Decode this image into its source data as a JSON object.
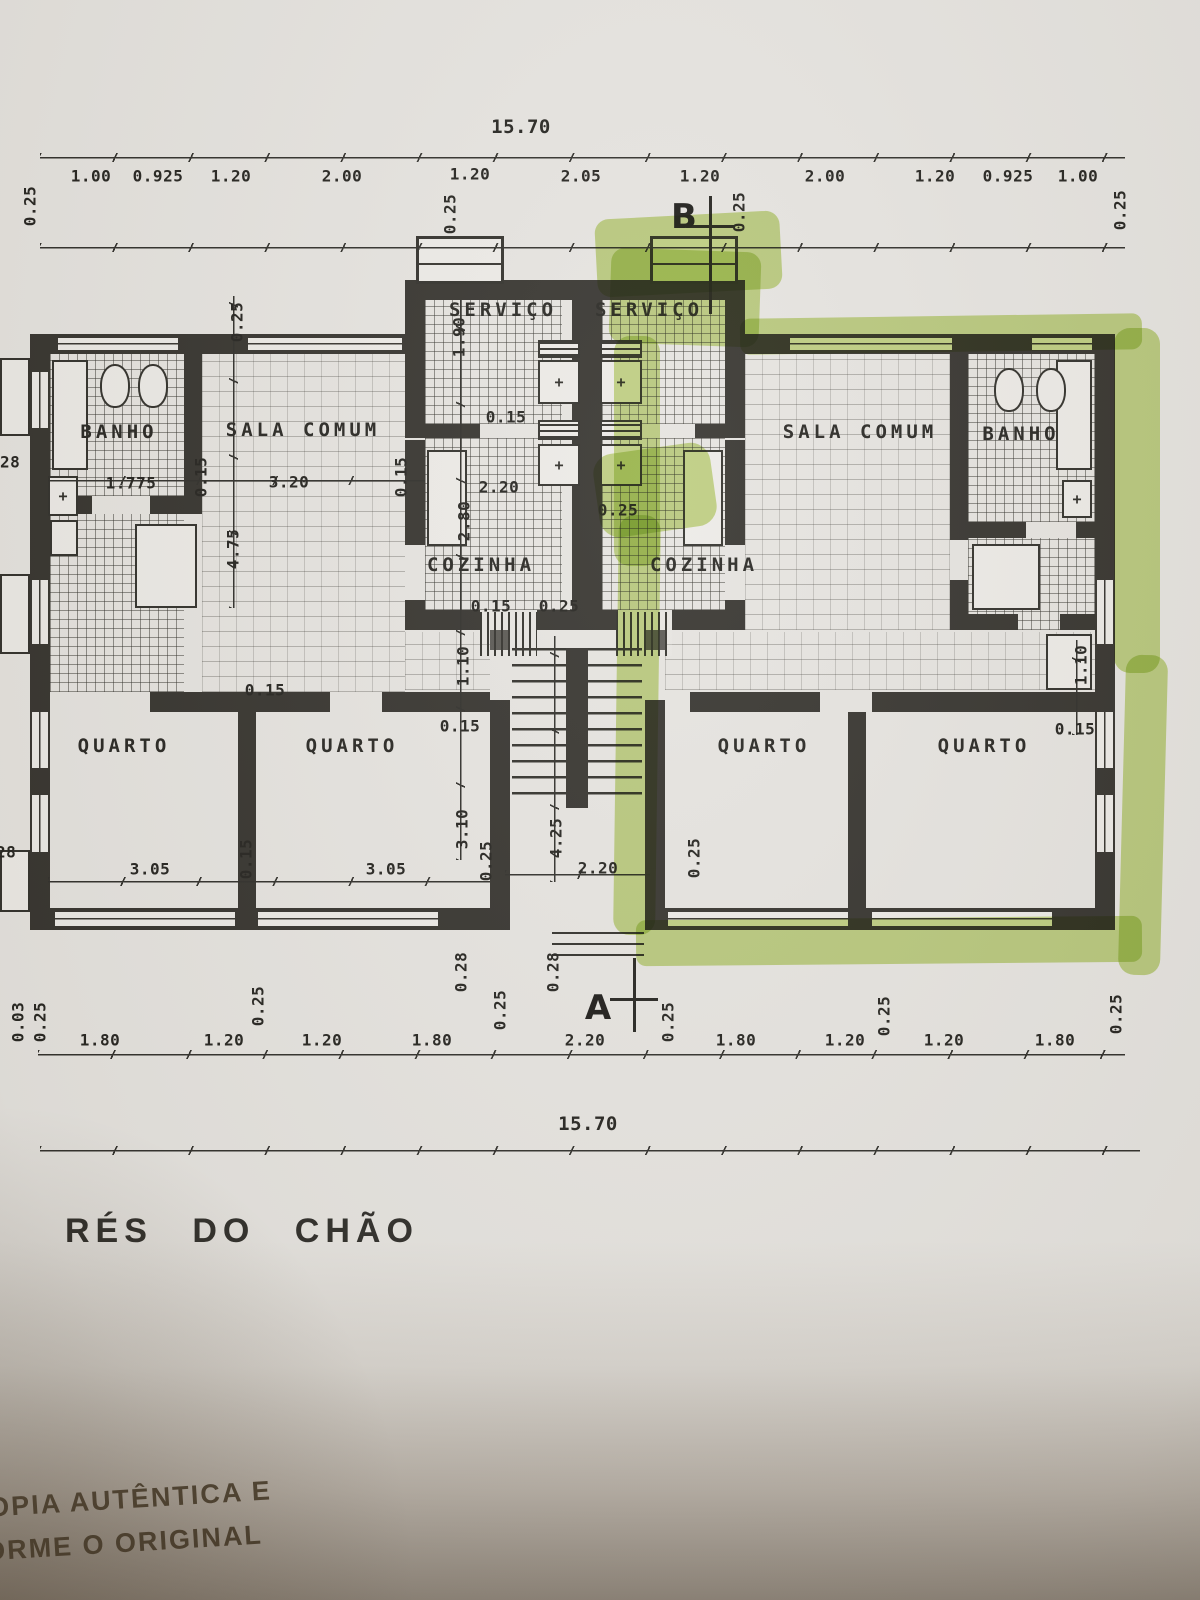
{
  "title": "RÉS DO CHÃO",
  "markers": {
    "a": "A",
    "b": "B"
  },
  "rooms": {
    "banho_l": "BANHO",
    "sala_l": "SALA COMUM",
    "servico_l": "SERVIÇO",
    "servico_r": "SERVIÇO",
    "cozinha_l": "COZINHA",
    "cozinha_r": "COZINHA",
    "sala_r": "SALA COMUM",
    "banho_r": "BANHO",
    "quarto_l1": "QUARTO",
    "quarto_l2": "QUARTO",
    "quarto_r1": "QUARTO",
    "quarto_r2": "QUARTO"
  },
  "dims": {
    "overall_top": "15.70",
    "overall_bottom": "15.70",
    "top": [
      "0.25",
      "1.00",
      "0.925",
      "1.20",
      "2.00",
      "0.25",
      "1.20",
      "2.05",
      "1.20",
      "0.25",
      "2.00",
      "1.20",
      "0.925",
      "1.00",
      "0.25"
    ],
    "bottom": [
      "0.03",
      "0.25",
      "1.80",
      "1.20",
      "0.25",
      "1.20",
      "1.80",
      "0.25",
      "2.20",
      "0.25",
      "1.80",
      "1.20",
      "0.25",
      "1.20",
      "1.80",
      "0.25"
    ],
    "left_edge": [
      "0.28",
      "0.28"
    ],
    "inner": {
      "sala_top_025": "0.25",
      "servico_190": "1.90",
      "servico_015": "0.15",
      "banho_1775": "1.775",
      "banho_015": "0.15",
      "sala_320": "3.20",
      "sala_015": "0.15",
      "sala_475": "4.75",
      "coz_220": "2.20",
      "coz_280": "2.80",
      "center_025": "0.25",
      "coz_015": "0.15",
      "coz_025": "0.25",
      "corr_015_l": "0.15",
      "corr_110_l": "1.10",
      "corr_015_l2": "0.15",
      "corr_015_r": "0.15",
      "corr_110_r": "1.10",
      "q_305_a": "3.05",
      "q_015": "0.15",
      "q_305_b": "3.05",
      "q_310": "3.10",
      "q_025_a": "0.25",
      "st_425": "4.25",
      "st_220": "2.20",
      "st_025": "0.25",
      "st_028_a": "0.28",
      "st_028_b": "0.28"
    }
  },
  "fixture_cross": "+",
  "stamp": {
    "line1": "OPIA AUTÊNTICA E",
    "line2": "ORME O ORIGINAL"
  },
  "colors": {
    "highlighter": "#a8c93e",
    "wall_ink": "#32302b",
    "paper": "#e5e3df"
  }
}
